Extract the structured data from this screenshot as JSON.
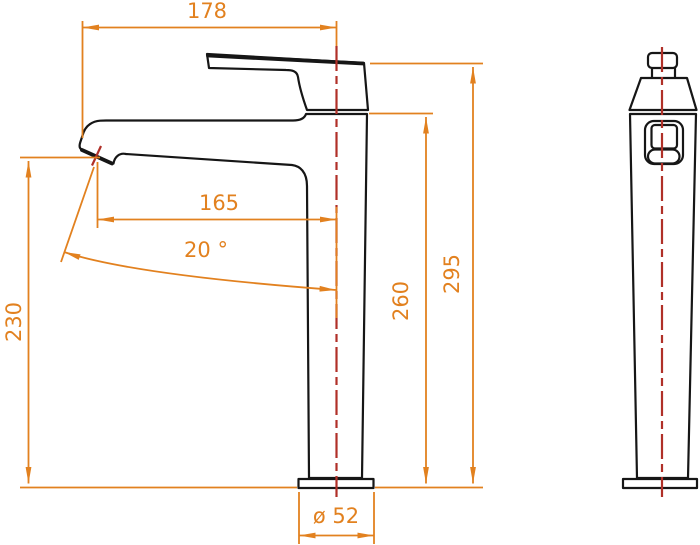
{
  "colors": {
    "dimension": "#e2811f",
    "centerline": "#b03028",
    "outline": "#161616",
    "background": "#ffffff"
  },
  "dimensions": {
    "overall_width": {
      "label": "178"
    },
    "spout_reach": {
      "label": "165"
    },
    "spout_angle": {
      "label": "20 °"
    },
    "spout_height": {
      "label": "230"
    },
    "body_height": {
      "label": "260"
    },
    "overall_height": {
      "label": "295"
    },
    "base_diameter": {
      "label": "ø 52"
    }
  }
}
